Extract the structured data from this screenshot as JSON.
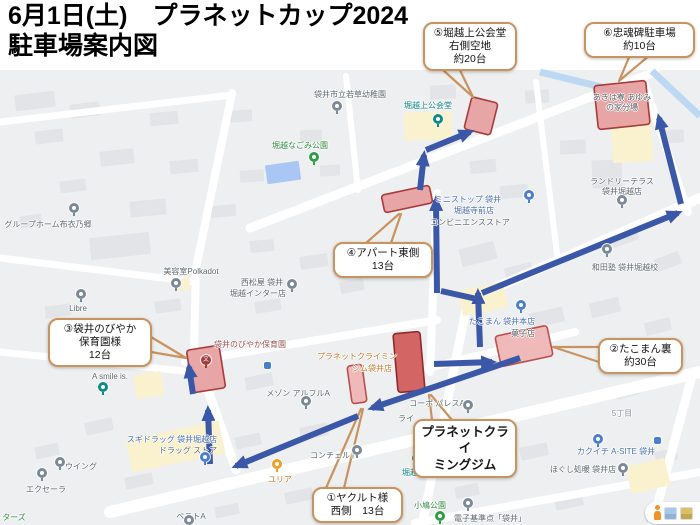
{
  "title": {
    "line1": "6月1日(土)　プラネットカップ2024",
    "line2": "駐車場案内図"
  },
  "colors": {
    "route_blue": "#3a57a8",
    "callout_border": "#c8935e",
    "parking_fill_light": "#e59c9c",
    "parking_fill_pale": "#efb3b3",
    "parking_fill_dark": "#cf5555",
    "parking_stroke": "#a93a3a",
    "water_blue": "#bcd8f2",
    "pond_blue": "#a9c6f4"
  },
  "map": {
    "labels": [
      {
        "text": "袋井市立若草幼稚園",
        "x": 350,
        "y": 89,
        "cls": "gray"
      },
      {
        "text": "堀越上公会堂",
        "x": 428,
        "y": 100,
        "cls": "teal"
      },
      {
        "text": "堀越なごみ公園",
        "x": 300,
        "y": 140,
        "cls": "green"
      },
      {
        "text": "グループホーム布衣乃郷",
        "x": 48,
        "y": 219,
        "cls": "gray"
      },
      {
        "text": "あきは寮 あゆみ",
        "x": 622,
        "y": 92,
        "cls": "gray"
      },
      {
        "text": "の家分場",
        "x": 622,
        "y": 102,
        "cls": "gray"
      },
      {
        "text": "ランドリーテラス",
        "x": 622,
        "y": 176,
        "cls": "gray"
      },
      {
        "text": "袋井堀越店",
        "x": 622,
        "y": 186,
        "cls": "gray"
      },
      {
        "text": "ミニストップ 袋井",
        "x": 468,
        "y": 194,
        "cls": "blue"
      },
      {
        "text": "堀越寺前店",
        "x": 474,
        "y": 205,
        "cls": "blue"
      },
      {
        "text": "コンビニエンスストア",
        "x": 470,
        "y": 217,
        "cls": "gray"
      },
      {
        "text": "和田塾 袋井堀越校",
        "x": 625,
        "y": 262,
        "cls": "gray"
      },
      {
        "text": "美容室Polkadot",
        "x": 191,
        "y": 266,
        "cls": "gray"
      },
      {
        "text": "西松屋 袋井",
        "x": 262,
        "y": 277,
        "cls": "gray"
      },
      {
        "text": "堀越インター店",
        "x": 258,
        "y": 288,
        "cls": "gray"
      },
      {
        "text": "Libre",
        "x": 78,
        "y": 304,
        "cls": "gray"
      },
      {
        "text": "たこまん 袋井本店",
        "x": 502,
        "y": 316,
        "cls": "blue"
      },
      {
        "text": "菓子店",
        "x": 523,
        "y": 328,
        "cls": "gray"
      },
      {
        "text": "袋井のびやか保育園",
        "x": 250,
        "y": 339,
        "cls": "darkred"
      },
      {
        "text": "プラネットクライミン",
        "x": 357,
        "y": 351,
        "cls": "orange"
      },
      {
        "text": "ジム袋井店",
        "x": 372,
        "y": 363,
        "cls": "orange"
      },
      {
        "text": "A smile is.",
        "x": 110,
        "y": 372,
        "cls": "gray"
      },
      {
        "text": "メゾン アルフルA",
        "x": 298,
        "y": 388,
        "cls": "gray"
      },
      {
        "text": "コーポ パレスA",
        "x": 437,
        "y": 398,
        "cls": "gray"
      },
      {
        "text": "ライ",
        "x": 406,
        "y": 413,
        "cls": "gray"
      },
      {
        "text": "グレイス",
        "x": 480,
        "y": 450,
        "cls": "gray"
      },
      {
        "text": "スギドラッグ 袋井堀越店",
        "x": 172,
        "y": 434,
        "cls": "blue"
      },
      {
        "text": "ドラッグ ストア",
        "x": 188,
        "y": 445,
        "cls": "gray"
      },
      {
        "text": "ウイング",
        "x": 81,
        "y": 461,
        "cls": "gray"
      },
      {
        "text": "エクセーラ",
        "x": 46,
        "y": 484,
        "cls": "gray"
      },
      {
        "text": "ユリア",
        "x": 280,
        "y": 474,
        "cls": "orange"
      },
      {
        "text": "コンチェルト",
        "x": 334,
        "y": 450,
        "cls": "gray"
      },
      {
        "text": "ベストA",
        "x": 191,
        "y": 511,
        "cls": "gray"
      },
      {
        "text": "堀越記念館",
        "x": 422,
        "y": 467,
        "cls": "teal"
      },
      {
        "text": "カクイチ A-SITE 袋井",
        "x": 616,
        "y": 446,
        "cls": "blue"
      },
      {
        "text": "ほぐし処暖 袋井店",
        "x": 583,
        "y": 464,
        "cls": "gray"
      },
      {
        "text": "5丁目",
        "x": 622,
        "y": 408,
        "cls": "gray2"
      },
      {
        "text": "小鳩公園",
        "x": 430,
        "y": 500,
        "cls": "green"
      },
      {
        "text": "電子基準点「袋井」",
        "x": 490,
        "y": 513,
        "cls": "gray"
      },
      {
        "text": "ターズ",
        "x": 14,
        "y": 512,
        "cls": "green"
      }
    ],
    "pins": [
      {
        "x": 337,
        "y": 101,
        "c": "gray"
      },
      {
        "x": 438,
        "y": 114,
        "c": "teal"
      },
      {
        "x": 314,
        "y": 152,
        "c": "green"
      },
      {
        "x": 74,
        "y": 203,
        "c": "gray"
      },
      {
        "x": 622,
        "y": 195,
        "c": "gray"
      },
      {
        "x": 529,
        "y": 190,
        "c": "blue"
      },
      {
        "x": 607,
        "y": 244,
        "c": "gray"
      },
      {
        "x": 176,
        "y": 278,
        "c": "gray"
      },
      {
        "x": 292,
        "y": 279,
        "c": "gray"
      },
      {
        "x": 81,
        "y": 289,
        "c": "gray"
      },
      {
        "x": 521,
        "y": 300,
        "c": "blue"
      },
      {
        "x": 206,
        "y": 355,
        "c": "school"
      },
      {
        "x": 103,
        "y": 382,
        "c": "teal"
      },
      {
        "x": 306,
        "y": 396,
        "c": "gray"
      },
      {
        "x": 468,
        "y": 400,
        "c": "gray"
      },
      {
        "x": 497,
        "y": 445,
        "c": "gray"
      },
      {
        "x": 205,
        "y": 452,
        "c": "blue"
      },
      {
        "x": 60,
        "y": 457,
        "c": "gray"
      },
      {
        "x": 42,
        "y": 468,
        "c": "gray"
      },
      {
        "x": 277,
        "y": 459,
        "c": "orange"
      },
      {
        "x": 357,
        "y": 445,
        "c": "gray"
      },
      {
        "x": 189,
        "y": 515,
        "c": "gray"
      },
      {
        "x": 417,
        "y": 453,
        "c": "teal"
      },
      {
        "x": 598,
        "y": 434,
        "c": "blue"
      },
      {
        "x": 623,
        "y": 463,
        "c": "gray"
      },
      {
        "x": 440,
        "y": 511,
        "c": "green"
      },
      {
        "x": 468,
        "y": 498,
        "c": "gray"
      }
    ],
    "transit_icons": [
      {
        "x": 264,
        "y": 362
      },
      {
        "x": 654,
        "y": 437
      }
    ],
    "parking_areas": [
      {
        "id": "5",
        "cx": 481,
        "cy": 116,
        "w": 27,
        "h": 33,
        "rot": 14,
        "shade": "light"
      },
      {
        "id": "6",
        "cx": 622,
        "cy": 105,
        "w": 52,
        "h": 44,
        "rot": -6,
        "shade": "light"
      },
      {
        "id": "4",
        "cx": 407,
        "cy": 199,
        "w": 49,
        "h": 18,
        "rot": -12,
        "shade": "light"
      },
      {
        "id": "3",
        "cx": 206,
        "cy": 369,
        "w": 33,
        "h": 43,
        "rot": -9,
        "shade": "light"
      },
      {
        "id": "gym",
        "cx": 409,
        "cy": 362,
        "w": 27,
        "h": 59,
        "rot": -5,
        "shade": "dark"
      },
      {
        "id": "1",
        "cx": 357,
        "cy": 384,
        "w": 15,
        "h": 38,
        "rot": -8,
        "shade": "pale"
      },
      {
        "id": "2",
        "cx": 524,
        "cy": 346,
        "w": 53,
        "h": 31,
        "rot": -12,
        "shade": "pale"
      }
    ],
    "routes": [
      {
        "points": [
          [
            520,
            358
          ],
          [
            372,
            408
          ]
        ],
        "head": true
      },
      {
        "points": [
          [
            358,
            416
          ],
          [
            236,
            466
          ]
        ],
        "head": true
      },
      {
        "points": [
          [
            210,
            464
          ],
          [
            208,
            410
          ]
        ],
        "head": true
      },
      {
        "points": [
          [
            193,
            394
          ],
          [
            189,
            367
          ]
        ],
        "head": true
      },
      {
        "points": [
          [
            480,
            347
          ],
          [
            478,
            293
          ]
        ],
        "head": true
      },
      {
        "points": [
          [
            477,
            299
          ],
          [
            441,
            291
          ]
        ],
        "head": false
      },
      {
        "points": [
          [
            437,
            293
          ],
          [
            436,
            200
          ]
        ],
        "head": true
      },
      {
        "points": [
          [
            420,
            190
          ],
          [
            424,
            155
          ]
        ],
        "head": true
      },
      {
        "points": [
          [
            426,
            150
          ],
          [
            470,
            132
          ]
        ],
        "head": true
      },
      {
        "points": [
          [
            482,
            293
          ],
          [
            678,
            213
          ]
        ],
        "head": true
      },
      {
        "points": [
          [
            681,
            204
          ],
          [
            659,
            118
          ]
        ],
        "head": true
      },
      {
        "points": [
          [
            434,
            364
          ],
          [
            492,
            362
          ]
        ],
        "head": true
      }
    ],
    "callouts": [
      {
        "id": "5",
        "x": 423,
        "y": 22,
        "w": 94,
        "bold": false,
        "lines": [
          "⑤堀越上公会堂",
          "右側空地",
          "約20台"
        ],
        "tails": [
          [
            [
              434,
              62
            ],
            [
              473,
              97
            ]
          ],
          [
            [
              456,
              62
            ],
            [
              473,
              97
            ]
          ]
        ]
      },
      {
        "id": "6",
        "x": 584,
        "y": 22,
        "w": 111,
        "bold": false,
        "lines": [
          "⑥忠魂碑駐車場",
          "約10台"
        ],
        "tails": [
          [
            [
              630,
              55
            ],
            [
              619,
              81
            ]
          ],
          [
            [
              650,
              55
            ],
            [
              619,
              81
            ]
          ]
        ]
      },
      {
        "id": "4",
        "x": 333,
        "y": 242,
        "w": 100,
        "bold": false,
        "lines": [
          "④アパート東側",
          "13台"
        ],
        "tails": [
          [
            [
              366,
              243
            ],
            [
              399,
              214
            ]
          ],
          [
            [
              391,
              243
            ],
            [
              401,
              214
            ]
          ]
        ]
      },
      {
        "id": "3",
        "x": 48,
        "y": 318,
        "w": 104,
        "bold": false,
        "lines": [
          "③袋井のびやか",
          "保育園様",
          "12台"
        ],
        "tails": [
          [
            [
              151,
              337
            ],
            [
              186,
              358
            ]
          ],
          [
            [
              151,
              352
            ],
            [
              186,
              358
            ]
          ]
        ]
      },
      {
        "id": "2",
        "x": 598,
        "y": 338,
        "w": 85,
        "bold": false,
        "lines": [
          "②たこまん裏",
          "約30台"
        ],
        "tails": [
          [
            [
              599,
              347
            ],
            [
              553,
              347
            ]
          ],
          [
            [
              599,
              362
            ],
            [
              553,
              347
            ]
          ]
        ]
      },
      {
        "id": "1",
        "x": 312,
        "y": 487,
        "w": 91,
        "bold": false,
        "lines": [
          "①ヤクルト様",
          "西側　13台"
        ],
        "tails": [
          [
            [
              326,
              488
            ],
            [
              361,
              409
            ]
          ],
          [
            [
              344,
              488
            ],
            [
              363,
              409
            ]
          ]
        ]
      },
      {
        "id": "gym",
        "x": 413,
        "y": 419,
        "w": 104,
        "bold": true,
        "lines": [
          "プラネットクライ",
          "ミングジム"
        ],
        "tails": [
          [
            [
              432,
              420
            ],
            [
              429,
              395
            ]
          ],
          [
            [
              452,
              420
            ],
            [
              431,
              395
            ]
          ]
        ]
      }
    ]
  }
}
